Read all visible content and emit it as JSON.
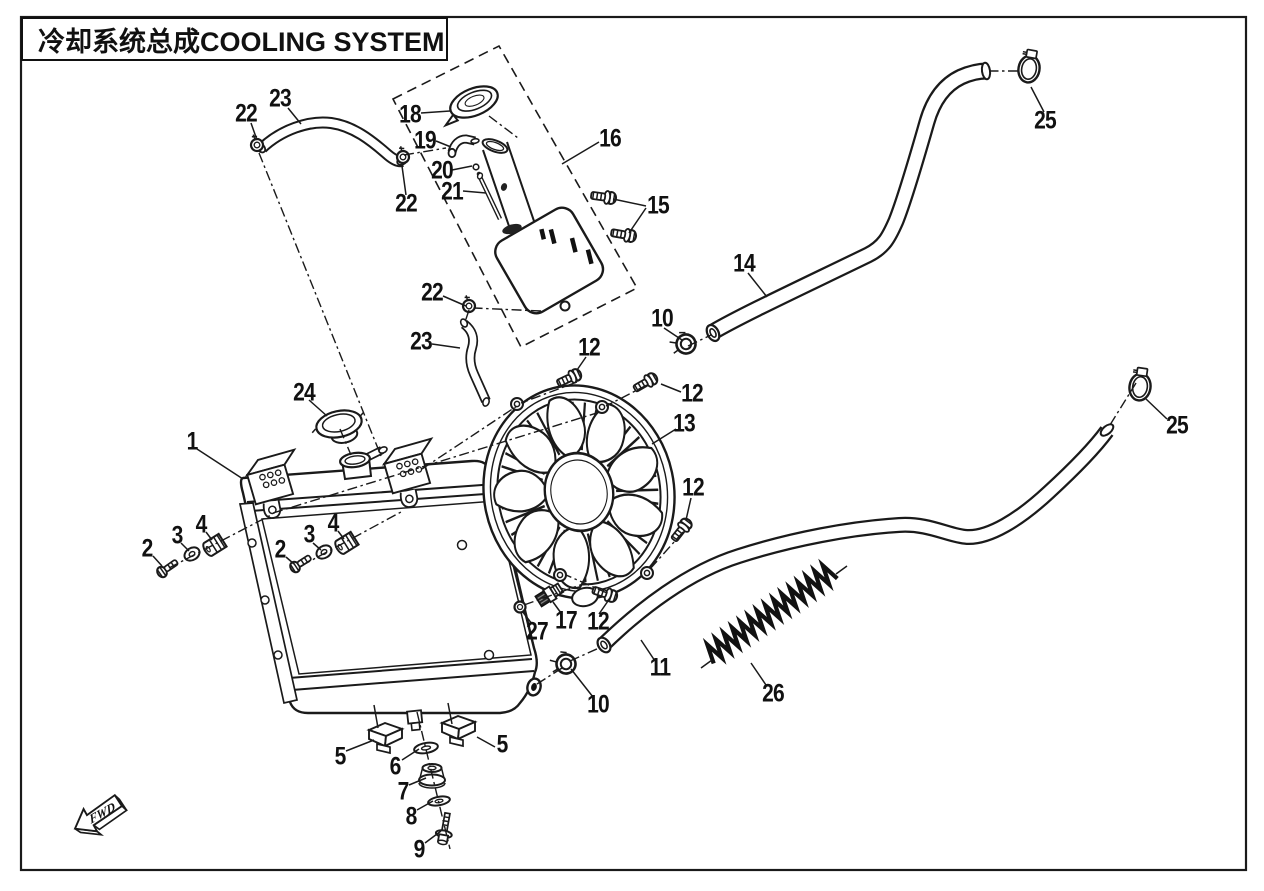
{
  "title": {
    "text": "冷却系统总成COOLING SYSTEM"
  },
  "direction_indicator": {
    "label": "FWD"
  },
  "diagram": {
    "type": "exploded-parts-diagram",
    "line_color": "#1a1a1a",
    "background": "#ffffff",
    "part_numbers_shown": [
      "1",
      "2",
      "3",
      "4",
      "5",
      "6",
      "7",
      "8",
      "9",
      "10",
      "11",
      "12",
      "13",
      "14",
      "15",
      "16",
      "17",
      "18",
      "19",
      "20",
      "21",
      "22",
      "23",
      "24",
      "25",
      "26",
      "27"
    ]
  },
  "callouts": [
    {
      "label": "1",
      "x": 192,
      "y": 442
    },
    {
      "label": "2",
      "x": 147,
      "y": 549
    },
    {
      "label": "3",
      "x": 177,
      "y": 536
    },
    {
      "label": "4",
      "x": 201,
      "y": 525
    },
    {
      "label": "2",
      "x": 280,
      "y": 550
    },
    {
      "label": "3",
      "x": 309,
      "y": 535
    },
    {
      "label": "4",
      "x": 333,
      "y": 524
    },
    {
      "label": "5",
      "x": 340,
      "y": 757
    },
    {
      "label": "5",
      "x": 502,
      "y": 745
    },
    {
      "label": "6",
      "x": 395,
      "y": 767
    },
    {
      "label": "7",
      "x": 403,
      "y": 792
    },
    {
      "label": "8",
      "x": 411,
      "y": 817
    },
    {
      "label": "9",
      "x": 419,
      "y": 850
    },
    {
      "label": "10",
      "x": 662,
      "y": 319
    },
    {
      "label": "10",
      "x": 598,
      "y": 705
    },
    {
      "label": "11",
      "x": 660,
      "y": 668
    },
    {
      "label": "12",
      "x": 589,
      "y": 348
    },
    {
      "label": "12",
      "x": 692,
      "y": 394
    },
    {
      "label": "12",
      "x": 693,
      "y": 488
    },
    {
      "label": "12",
      "x": 598,
      "y": 622
    },
    {
      "label": "13",
      "x": 684,
      "y": 424
    },
    {
      "label": "14",
      "x": 744,
      "y": 264
    },
    {
      "label": "15",
      "x": 658,
      "y": 206
    },
    {
      "label": "16",
      "x": 610,
      "y": 139
    },
    {
      "label": "17",
      "x": 566,
      "y": 621
    },
    {
      "label": "18",
      "x": 410,
      "y": 115
    },
    {
      "label": "19",
      "x": 425,
      "y": 141
    },
    {
      "label": "20",
      "x": 442,
      "y": 171
    },
    {
      "label": "21",
      "x": 452,
      "y": 192
    },
    {
      "label": "22",
      "x": 246,
      "y": 114
    },
    {
      "label": "22",
      "x": 406,
      "y": 204
    },
    {
      "label": "22",
      "x": 432,
      "y": 293
    },
    {
      "label": "23",
      "x": 280,
      "y": 99
    },
    {
      "label": "23",
      "x": 421,
      "y": 342
    },
    {
      "label": "24",
      "x": 304,
      "y": 393
    },
    {
      "label": "25",
      "x": 1045,
      "y": 121
    },
    {
      "label": "25",
      "x": 1177,
      "y": 426
    },
    {
      "label": "26",
      "x": 773,
      "y": 694
    },
    {
      "label": "27",
      "x": 537,
      "y": 632
    }
  ]
}
